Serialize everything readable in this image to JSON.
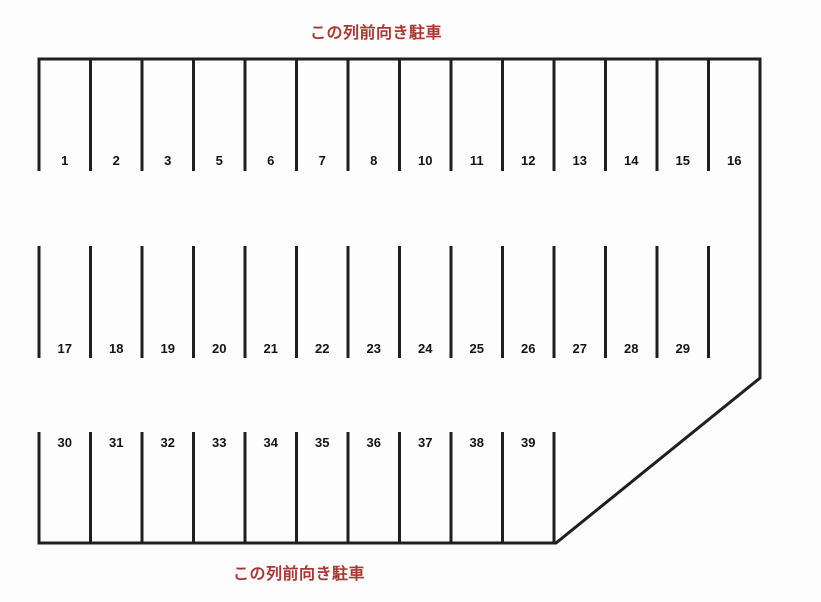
{
  "notes": {
    "top": "この列前向き駐車",
    "bottom": "この列前向き駐車"
  },
  "rows": [
    {
      "name": "top-row",
      "stalls": [
        "1",
        "2",
        "3",
        "5",
        "6",
        "7",
        "8",
        "10",
        "11",
        "12",
        "13",
        "14",
        "15",
        "16"
      ]
    },
    {
      "name": "middle-row",
      "stalls": [
        "17",
        "18",
        "19",
        "20",
        "21",
        "22",
        "23",
        "24",
        "25",
        "26",
        "27",
        "28",
        "29"
      ]
    },
    {
      "name": "bottom-row",
      "stalls": [
        "30",
        "31",
        "32",
        "33",
        "34",
        "35",
        "36",
        "37",
        "38",
        "39"
      ]
    }
  ],
  "colors": {
    "line": "#1f1f1f",
    "note_text": "#a83832",
    "stall_number": "#141414",
    "background": "#fdfdfd"
  }
}
